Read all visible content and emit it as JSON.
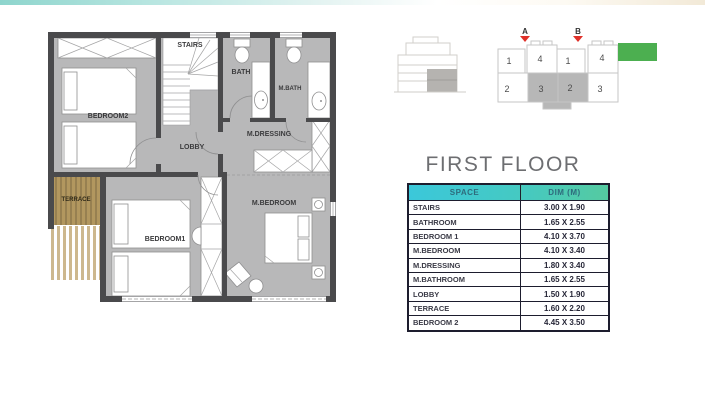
{
  "title": "FIRST FLOOR",
  "colors": {
    "accent_teal": "#3bc8da",
    "accent_green": "#55caa0",
    "legend_green": "#4caf50",
    "marker_red": "#e0312a",
    "wall_gray": "#4a4a4c",
    "room_gray": "#b8b8b9",
    "terrace_wood": "#b2975f"
  },
  "floor_plan": {
    "rooms": [
      {
        "label": "STAIRS"
      },
      {
        "label": "BATH"
      },
      {
        "label": "M.BATH"
      },
      {
        "label": "BEDROOM2"
      },
      {
        "label": "M.DRESSING"
      },
      {
        "label": "LOBBY"
      },
      {
        "label": "TERRACE"
      },
      {
        "label": "BEDROOM1"
      },
      {
        "label": "M.BEDROOM"
      }
    ]
  },
  "key_plan": {
    "markers": [
      {
        "label": "A"
      },
      {
        "label": "B"
      }
    ],
    "units": [
      "1",
      "4",
      "1",
      "4",
      "2",
      "3",
      "2",
      "3"
    ],
    "shaded_units": [
      "3",
      "2"
    ]
  },
  "table": {
    "headers": [
      "SPACE",
      "DIM (M)"
    ],
    "rows": [
      {
        "space": "STAIRS",
        "dim": "3.00 X 1.90"
      },
      {
        "space": "BATHROOM",
        "dim": "1.65 X 2.55"
      },
      {
        "space": "BEDROOM 1",
        "dim": "4.10 X 3.70"
      },
      {
        "space": "M.BEDROOM",
        "dim": "4.10 X 3.40"
      },
      {
        "space": "M.DRESSING",
        "dim": "1.80 X 3.40"
      },
      {
        "space": "M.BATHROOM",
        "dim": "1.65 X 2.55"
      },
      {
        "space": "LOBBY",
        "dim": "1.50 X 1.90"
      },
      {
        "space": "TERRACE",
        "dim": "1.60 X 2.20"
      },
      {
        "space": "BEDROOM 2",
        "dim": "4.45 X 3.50"
      }
    ]
  }
}
